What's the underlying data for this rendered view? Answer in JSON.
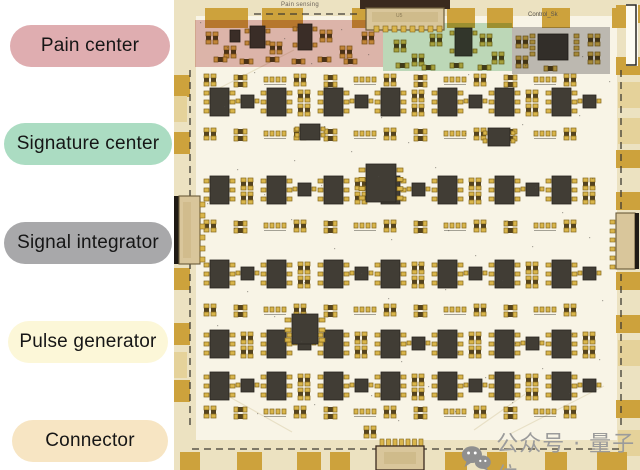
{
  "legend": {
    "items": [
      {
        "id": "pain-center",
        "label": "Pain center",
        "color": "#dfadb0"
      },
      {
        "id": "signature-center",
        "label": "Signature center",
        "color": "#abdcc2"
      },
      {
        "id": "signal-integrator",
        "label": "Signal integrator",
        "color": "#a8a8aa"
      },
      {
        "id": "pulse-generator",
        "label": "Pulse generator",
        "color": "#fcf7d8"
      },
      {
        "id": "connector",
        "label": "Connector",
        "color": "#f7e5c3"
      }
    ]
  },
  "pcb": {
    "silkscreen": {
      "top_label": "Pain sensing",
      "control_label": "Control_Sk",
      "top_connector_label": "U5"
    },
    "regions": [
      {
        "name": "pain-center-region",
        "color": "#c97f7f",
        "opacity": 0.52
      },
      {
        "name": "signature-center-region",
        "color": "#8fc9a0",
        "opacity": 0.55
      },
      {
        "name": "signal-integrator-region",
        "color": "#9a989b",
        "opacity": 0.6
      }
    ],
    "colors": {
      "board": "#ece2c1",
      "panel": "#f8f4e6",
      "tab_gold": "#cda23c",
      "tab_light": "#e5d29a",
      "chip": "#413d35",
      "chip_border": "#28251f",
      "pad": "#d9b54b",
      "pad_border": "#84671c",
      "passive_body": "#54431f",
      "silkscreen": "#3e3b33",
      "connector_body": "#d9c69b",
      "connector_border": "#6b5b3a",
      "connector_dark": "#3a2a1e",
      "bar_black": "#1f1a14"
    }
  },
  "watermark": {
    "icon": "wechat-icon",
    "text": "公众号 · 量子位",
    "color": "#9b9b9b"
  }
}
